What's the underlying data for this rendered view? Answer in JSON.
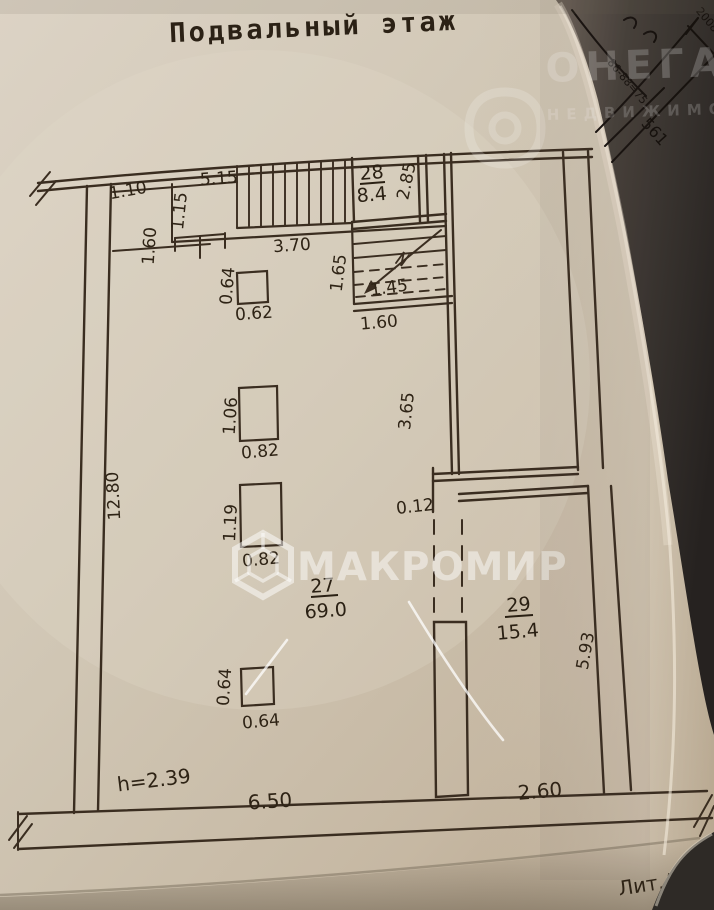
{
  "document": {
    "title": "Подвальный этаж",
    "litera": "Лит.А",
    "height_note": "h=2.39"
  },
  "rooms": {
    "r27": {
      "number": "27",
      "area": "69.0"
    },
    "r28": {
      "number": "28",
      "area": "8.4"
    },
    "r29": {
      "number": "29",
      "area": "15.4"
    }
  },
  "dims": {
    "d1_10": "1.10",
    "d1_60a": "1.60",
    "d1_15": "1.15",
    "d5_15": "5.15",
    "d3_70": "3.70",
    "d2_85": "2.85",
    "d1_65": "1.65",
    "d1_45": "1.45",
    "d1_60b": "1.60",
    "d3_65": "3.65",
    "d0_64a": "0.64",
    "d0_62": "0.62",
    "d1_06": "1.06",
    "d0_82a": "0.82",
    "d1_19": "1.19",
    "d0_82b": "0.82",
    "d0_12": "0.12",
    "d5_93": "5.93",
    "d0_64b": "0.64",
    "d0_64c": "0.64",
    "d12_80": "12.80",
    "d6_50": "6.50",
    "d2_60": "2.60"
  },
  "watermarks": {
    "center_text": "МАКРОМИР",
    "corner_brand": "ОНЕГА",
    "corner_sub": "НЕДВИЖИМОСТЬ"
  },
  "handwriting": {
    "h1": "561",
    "h2": "86-88=75",
    "h3": "2008"
  },
  "colors": {
    "ink": "#3a2d20",
    "paper": "#cfc5b3",
    "dark_page": "#352f2a"
  }
}
